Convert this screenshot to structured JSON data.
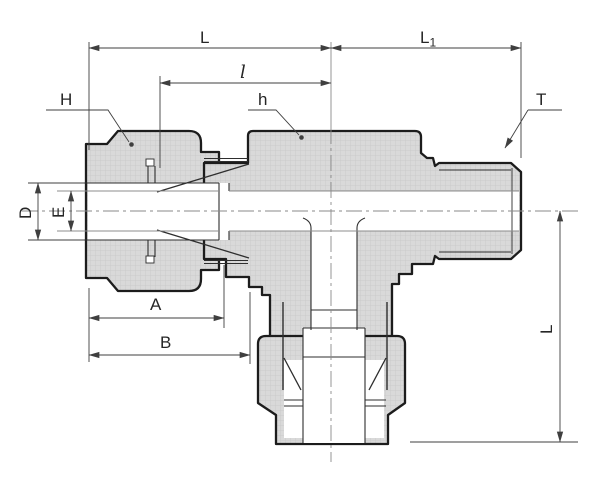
{
  "colors": {
    "metal": "#d9d9d9",
    "outline": "#1c1c1c",
    "detail": "#2e2e2e",
    "bore_line": "#8c8c8c",
    "centerline": "#8a8a8a",
    "dimension": "#3f3f3f",
    "text": "#262626",
    "background": "#ffffff"
  },
  "labels": {
    "overall_length_left": "L",
    "overall_length_right": "L",
    "overall_length_right_sub": "1",
    "center_to_end": "l",
    "nut_hex": "H",
    "body_hex": "h",
    "thread": "T",
    "tube_outer_dia": "D",
    "tube_inner_dia": "E",
    "nut_length": "A",
    "to_hex_length": "B",
    "branch_height": "L"
  }
}
